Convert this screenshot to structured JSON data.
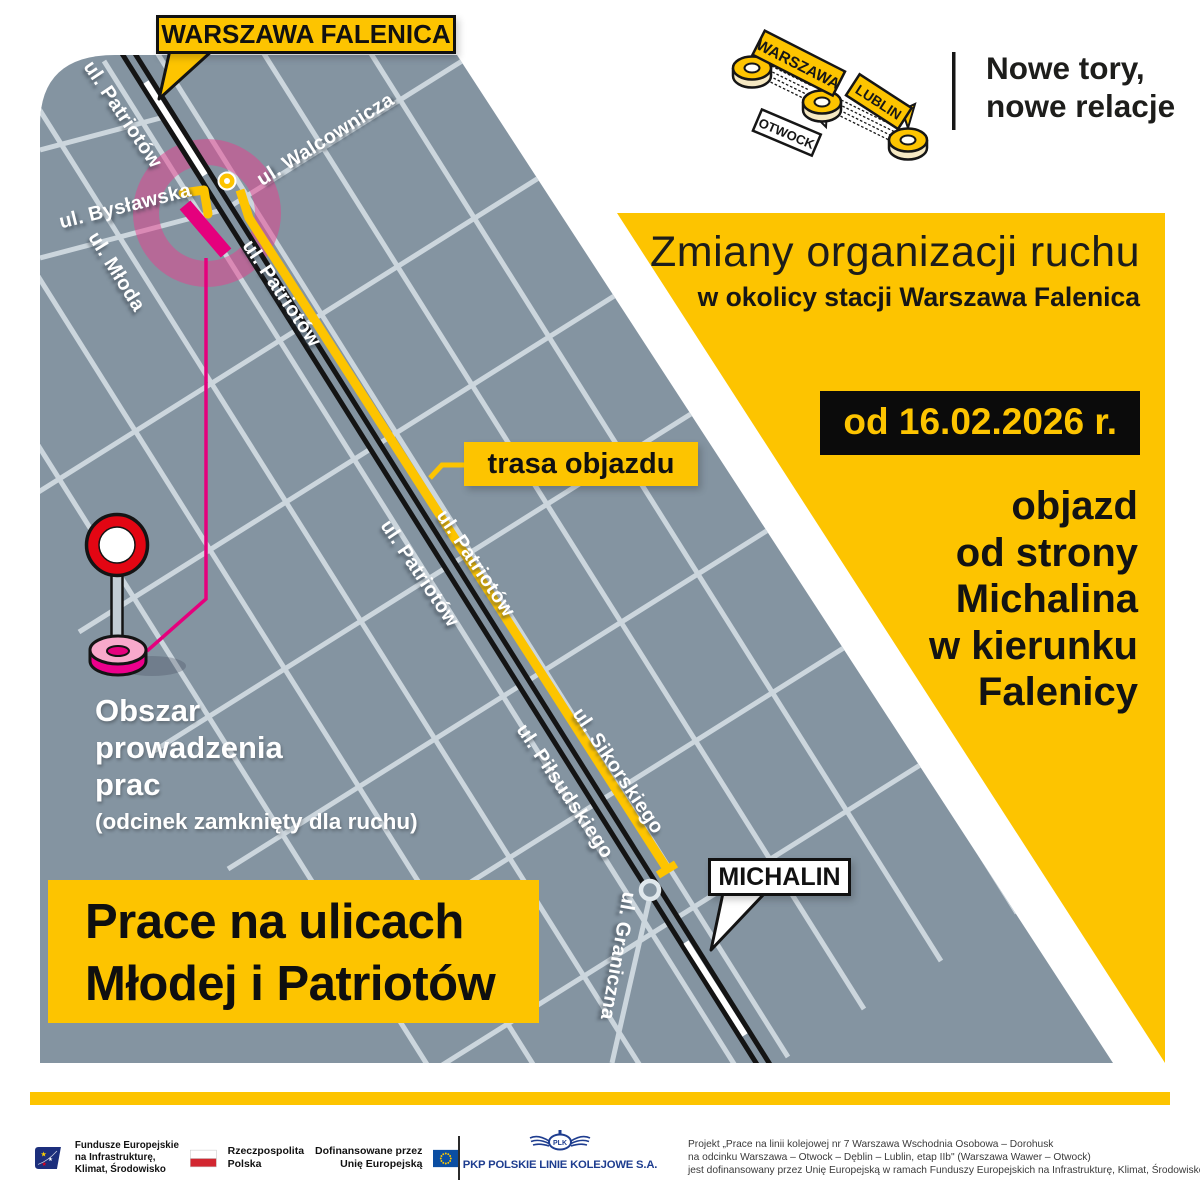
{
  "header": {
    "logo_stations": [
      {
        "label": "WARSZAWA"
      },
      {
        "label": "LUBLIN"
      },
      {
        "label": "OTWOCK"
      }
    ],
    "tagline": {
      "line1": "Nowe tory,",
      "line2": "nowe relacje"
    }
  },
  "map": {
    "station_callout": "WARSZAWA FALENICA",
    "michalin_callout": "MICHALIN",
    "detour_callout": "trasa objazdu",
    "work_area": {
      "line1": "Obszar",
      "line2": "prowadzenia",
      "line3": "prac",
      "note": "(odcinek zamknięty dla ruchu)"
    },
    "banner": {
      "line1": "Prace na ulicach",
      "line2": "Młodej i Patriotów"
    },
    "streets": [
      {
        "label": "ul. Patriotów"
      },
      {
        "label": "ul. Walcownicza"
      },
      {
        "label": "ul. Bysławska"
      },
      {
        "label": "ul. Młoda"
      },
      {
        "label": "ul. Patriotów"
      },
      {
        "label": "ul. Patriotów"
      },
      {
        "label": "ul. Patriotów"
      },
      {
        "label": "ul. Piłsudskiego"
      },
      {
        "label": "ul. Sikorskiego"
      },
      {
        "label": "ul. Graniczna"
      }
    ]
  },
  "info_panel": {
    "title": "Zmiany organizacji ruchu",
    "subtitle": "w okolicy stacji Warszawa Falenica",
    "date_badge": "od 16.02.2026 r.",
    "detour": {
      "line1": "objazd",
      "line2": "od strony",
      "line3": "Michalina",
      "line4": "w kierunku",
      "line5": "Falenicy"
    }
  },
  "footer": {
    "eu_program": {
      "line1": "Fundusze Europejskie",
      "line2": "na Infrastrukturę,",
      "line3": "Klimat, Środowisko"
    },
    "poland": {
      "line1": "Rzeczpospolita",
      "line2": "Polska"
    },
    "eu_funding": {
      "line1": "Dofinansowane przez",
      "line2": "Unię Europejską"
    },
    "pkp_emblem": "PLK",
    "pkp_name": "PKP POLSKIE LINIE KOLEJOWE S.A.",
    "project": {
      "line1": "Projekt „Prace na linii kolejowej nr 7 Warszawa Wschodnia Osobowa – Dorohusk",
      "line2": "na odcinku Warszawa – Otwock – Dęblin – Lublin, etap IIb\" (Warszawa Wawer – Otwock)",
      "line3": "jest dofinansowany przez Unię Europejską w ramach Funduszy Europejskich na Infrastrukturę, Klimat, Środowisko 2021-2027"
    }
  },
  "colors": {
    "accent_yellow": "#fdc400",
    "magenta": "#e5007d",
    "map_gray": "#8494a1",
    "street": "#ccd6dd",
    "pkp_blue": "#1e3d8f",
    "eu_blue": "#0b4ea2",
    "flag_red": "#d22630",
    "sign_red": "#e30613"
  }
}
